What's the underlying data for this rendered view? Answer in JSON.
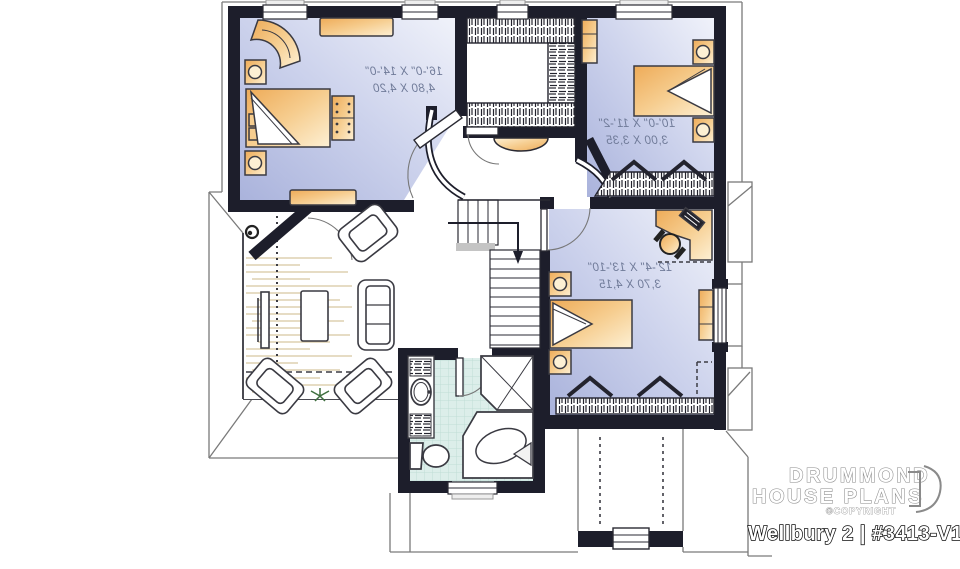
{
  "branding": {
    "company_line1": "DRUMMOND",
    "company_line2": "HOUSE PLANS",
    "copyright_text": "©COPYRIGHT",
    "plan_label": "Wellbury 2 | #3413-V1"
  },
  "rooms": {
    "master_bedroom": {
      "dim_imperial": "16'-0\" X 14'-0\"",
      "dim_metric": "4,80 X 4,20"
    },
    "bedroom_2": {
      "dim_imperial": "10'-0\" X 11'-2\"",
      "dim_metric": "3,00 X 3,35"
    },
    "bedroom_3": {
      "dim_imperial": "12'-4\" X 13'-10\"",
      "dim_metric": "3,70 X 4,15"
    }
  },
  "colors": {
    "wall": "#1d1e2b",
    "bedroom_floor_dark": "#aab3dc",
    "bedroom_floor_light": "#f0f2fa",
    "furniture_dark": "#eeab58",
    "furniture_light": "#fdf0d4",
    "bath_tile": "#dceeea",
    "dimension_text": "#707b99",
    "roof_line": "#7a7a7a"
  }
}
